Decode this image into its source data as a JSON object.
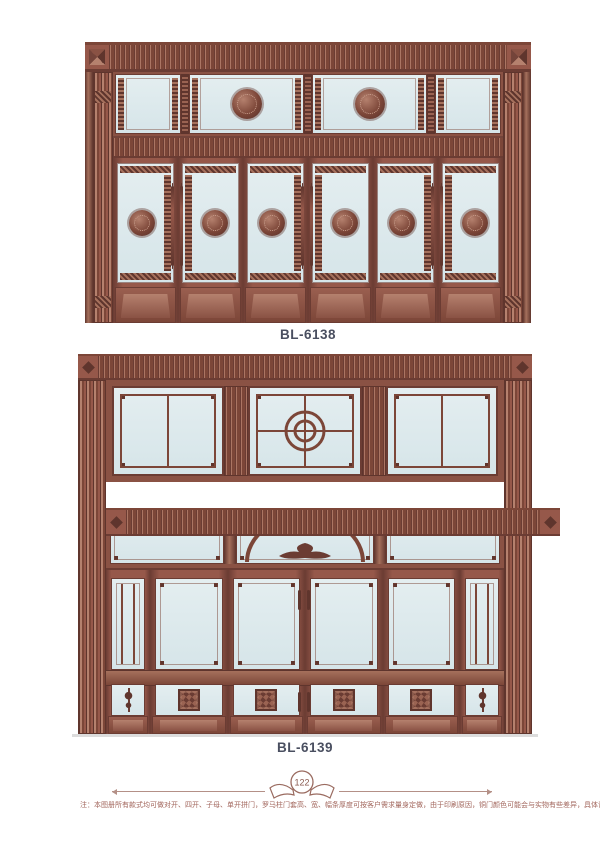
{
  "catalog": {
    "products": [
      {
        "model": "BL-6138"
      },
      {
        "model": "BL-6139"
      }
    ],
    "footer": {
      "page_number": "122",
      "note": "注：本图册所有款式均可做对开、四开、子母、单开拼门，罗马柱门套高、宽、幅条厚度可按客户需求量身定做，由于印刷原因，铜门颜色可能会与实物有些差异，具体请参照色卡。"
    },
    "colors": {
      "copper": "#96584a",
      "copper_dark": "#6b3c33",
      "glass": "#dde9ec",
      "label_text": "#4a4f60",
      "note_text": "#a2665c"
    }
  }
}
